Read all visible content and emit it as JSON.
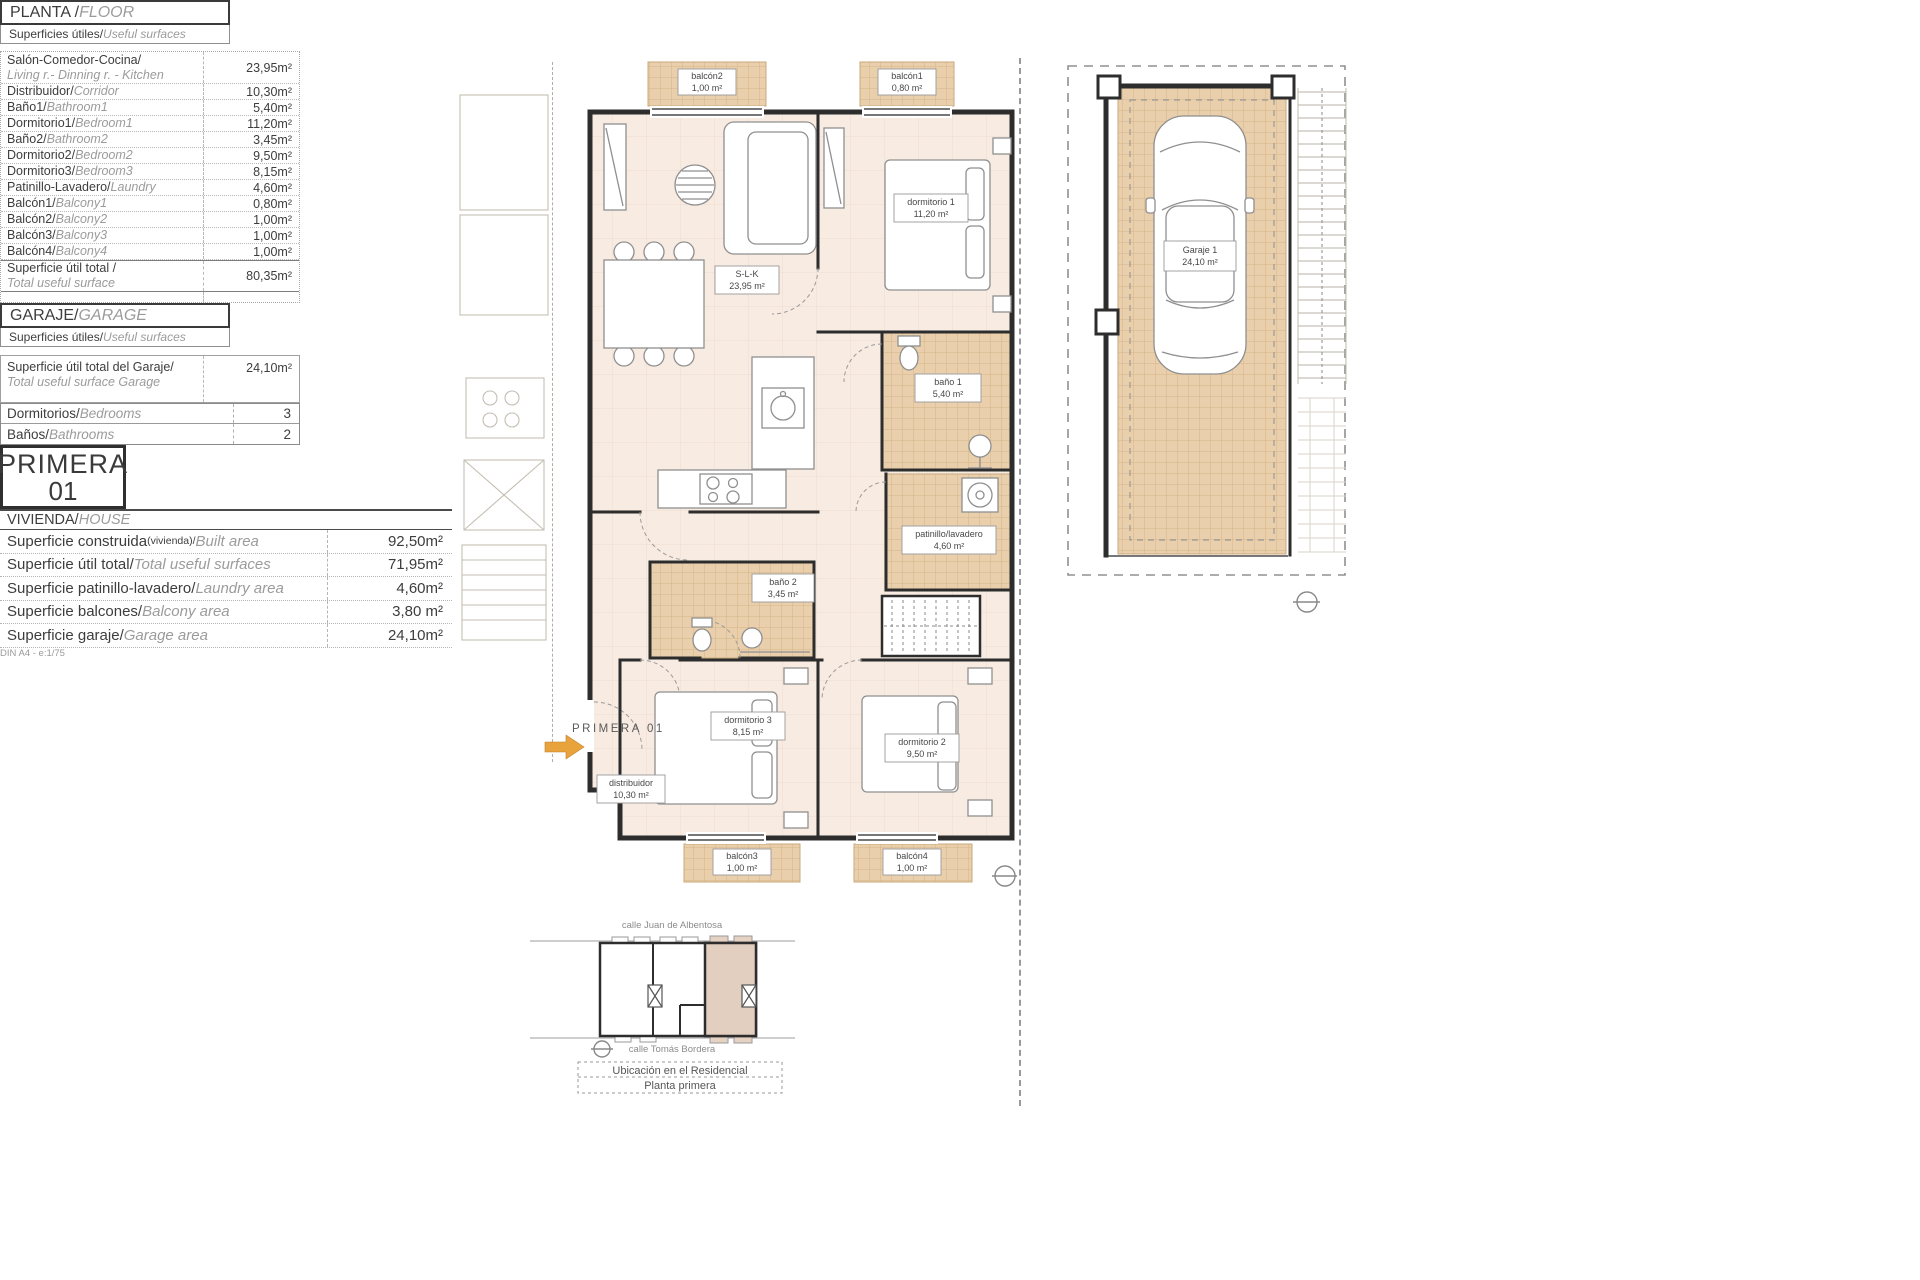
{
  "page": {
    "scale_note": "DIN A4 - e:1/75"
  },
  "plan": {
    "entry": "PRIMERA 01",
    "rooms": {
      "slk": {
        "name": "S-L-K",
        "area": "23,95 m²"
      },
      "dorm1": {
        "name": "dormitorio 1",
        "area": "11,20 m²"
      },
      "bano1": {
        "name": "baño 1",
        "area": "5,40 m²"
      },
      "patinillo": {
        "name": "patinillo/lavadero",
        "area": "4,60 m²"
      },
      "bano2": {
        "name": "baño 2",
        "area": "3,45 m²"
      },
      "dorm3": {
        "name": "dormitorio 3",
        "area": "8,15 m²"
      },
      "dorm2": {
        "name": "dormitorio 2",
        "area": "9,50 m²"
      },
      "distribuidor": {
        "name": "distribuidor",
        "area": "10,30 m²"
      },
      "balcon1": {
        "name": "balcón1",
        "area": "0,80 m²"
      },
      "balcon2": {
        "name": "balcón2",
        "area": "1,00 m²"
      },
      "balcon3": {
        "name": "balcón3",
        "area": "1,00 m²"
      },
      "balcon4": {
        "name": "balcón4",
        "area": "1,00 m²"
      }
    }
  },
  "garage_plan": {
    "name": "Garaje 1",
    "area": "24,10 m²"
  },
  "location": {
    "street_top": "calle Juan de Albentosa",
    "street_bottom": "calle Tomás Bordera",
    "caption_line1": "Ubicación en el Residencial",
    "caption_line2": "Planta primera"
  },
  "floor_section": {
    "title_es": "PLANTA / ",
    "title_en": "FLOOR",
    "subtitle_es": "Superficies útiles/",
    "subtitle_en": "Useful surfaces",
    "rows": [
      {
        "es": "Salón-Comedor-Cocina/",
        "en": "Living r.- Dinning r. - Kitchen",
        "value": "23,95m²"
      },
      {
        "es": "Distribuidor/",
        "en": "Corridor",
        "value": "10,30m²"
      },
      {
        "es": "Baño1/",
        "en": "Bathroom1",
        "value": "5,40m²"
      },
      {
        "es": "Dormitorio1/",
        "en": "Bedroom1",
        "value": "11,20m²"
      },
      {
        "es": "Baño2/",
        "en": "Bathroom2",
        "value": "3,45m²"
      },
      {
        "es": "Dormitorio2/",
        "en": "Bedroom2",
        "value": "9,50m²"
      },
      {
        "es": "Dormitorio3/",
        "en": "Bedroom3",
        "value": "8,15m²"
      },
      {
        "es": "Patinillo-Lavadero/",
        "en": "Laundry",
        "value": "4,60m²"
      },
      {
        "es": "Balcón1/",
        "en": "Balcony1",
        "value": "0,80m²"
      },
      {
        "es": "Balcón2/",
        "en": "Balcony2",
        "value": "1,00m²"
      },
      {
        "es": "Balcón3/",
        "en": "Balcony3",
        "value": "1,00m²"
      },
      {
        "es": "Balcón4/",
        "en": "Balcony4",
        "value": "1,00m²"
      }
    ],
    "total_es": "Superficie útil total / ",
    "total_en": "Total useful surface",
    "total_value": "80,35m²"
  },
  "garage_section": {
    "title_es": "GARAJE/",
    "title_en": "GARAGE",
    "subtitle_es": "Superficies útiles/",
    "subtitle_en": "Useful surfaces",
    "row_es": "Superficie útil total del Garaje/",
    "row_en": "Total useful surface Garage",
    "value": "24,10m²"
  },
  "counts": {
    "bedrooms_es": "Dormitorios/",
    "bedrooms_en": "Bedrooms",
    "bedrooms_value": "3",
    "bathrooms_es": "Baños/",
    "bathrooms_en": "Bathrooms",
    "bathrooms_value": "2"
  },
  "unit_badge": {
    "line1": "PRIMERA",
    "line2": "01"
  },
  "house_section": {
    "title_es": "VIVIENDA/",
    "title_en": "HOUSE",
    "rows": [
      {
        "es": "Superficie construida",
        "es_small": "(vivienda)/",
        "en": "Built area",
        "value": "92,50m²"
      },
      {
        "es": "Superficie útil total/",
        "es_small": "",
        "en": "Total useful surfaces",
        "value": "71,95m²"
      },
      {
        "es": "Superficie patinillo-lavadero/",
        "es_small": "",
        "en": "Laundry area",
        "value": "4,60m²"
      },
      {
        "es": "Superficie balcones/",
        "es_small": "",
        "en": "Balcony area",
        "value": "3,80 m²"
      },
      {
        "es": "Superficie garaje/",
        "es_small": "",
        "en": "Garage area",
        "value": "24,10m²"
      }
    ]
  }
}
